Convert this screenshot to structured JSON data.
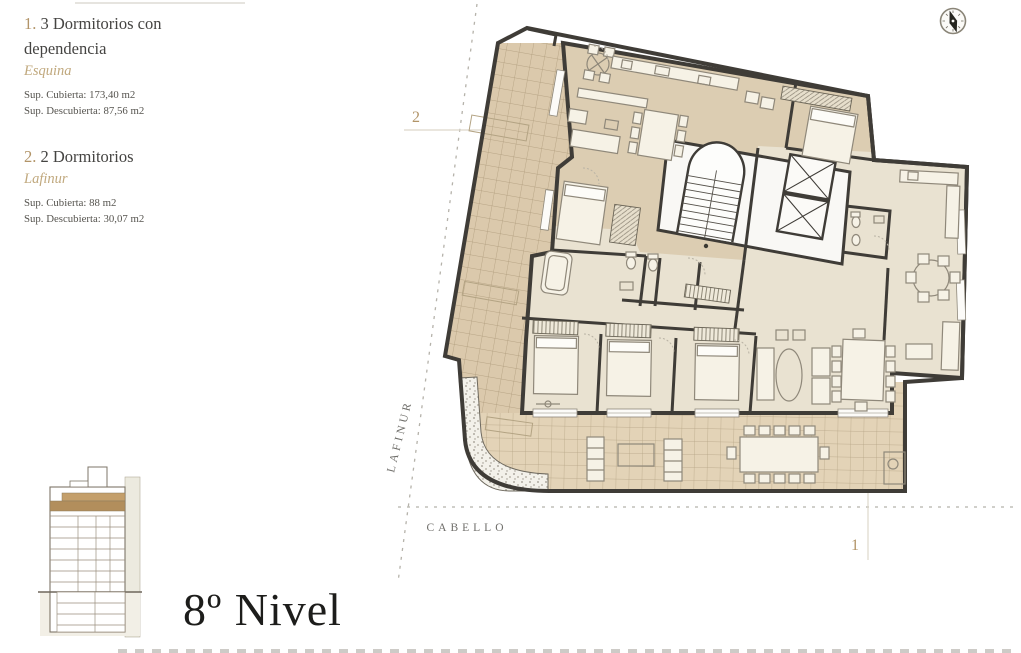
{
  "legend": {
    "units": [
      {
        "number": "1.",
        "title": "3 Dormitorios con dependencia",
        "name": "Esquina",
        "area_covered": "Sup. Cubierta: 173,40 m2",
        "area_uncovered": "Sup. Descubierta: 87,56 m2"
      },
      {
        "number": "2.",
        "title": "2 Dormitorios",
        "name": "Lafinur",
        "area_covered": "Sup. Cubierta: 88 m2",
        "area_uncovered": "Sup. Descubierta: 30,07 m2"
      }
    ]
  },
  "level": {
    "title": "8º Nivel"
  },
  "streets": {
    "vertical": "LAFINUR",
    "horizontal": "CABELLO"
  },
  "markers": {
    "unit1": "1",
    "unit2": "2"
  },
  "icons": {
    "compass": "north-compass-icon"
  },
  "colors": {
    "accent_tan": "#b29468",
    "wall": "#3f3c37",
    "terrace_tile": "#dbc9ac",
    "interior_floor": "#e9e2d1",
    "unit2_floor": "#dccdb2",
    "level_highlight": "#b28e5c",
    "street_text": "#6f6e6a"
  }
}
